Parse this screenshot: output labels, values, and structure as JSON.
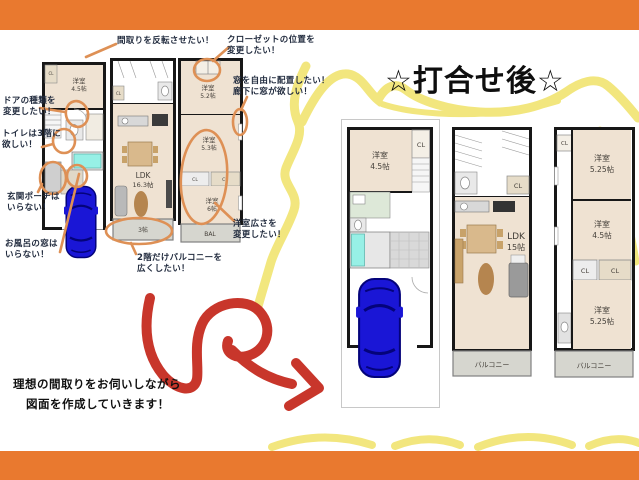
{
  "title": {
    "text": "☆打合せ後☆"
  },
  "message": {
    "line1": "理想の間取りをお伺いしながら",
    "line2": "図面を作成していきます！"
  },
  "annotations": {
    "flip": {
      "line1": "間取りを反転させたい！"
    },
    "closet": {
      "line1": "クローゼットの位置を",
      "line2": "変更したい！"
    },
    "free_window": {
      "line1": "窓を自由に配置したい！",
      "line2": "廊下に窓が欲しい！"
    },
    "door": {
      "line1": "ドアの種類を",
      "line2": "変更したい！"
    },
    "toilet": {
      "line1": "トイレは3階に",
      "line2": "欲しい！"
    },
    "porch": {
      "line1": "玄関ポーチは",
      "line2": "いらない！"
    },
    "bath_window": {
      "line1": "お風呂の窓は",
      "line2": "いらない！"
    },
    "room_size": {
      "line1": "洋室広さを",
      "line2": "変更したい！"
    },
    "balcony": {
      "line1": "2階だけバルコニーを",
      "line2": "広くしたい！"
    }
  },
  "before_plans": {
    "floor1": {
      "room1_name": "洋室",
      "room1_size": "4.5帖",
      "closet": "CL"
    },
    "floor2": {
      "closet": "CL",
      "ldk_name": "LDK",
      "ldk_size": "16.3帖",
      "balcony": "3帖"
    },
    "floor3": {
      "room1_name": "洋室",
      "room1_size": "5.2帖",
      "room2_name": "洋室",
      "room2_size": "5.3帖",
      "closet1": "CL",
      "closet2": "CL",
      "room3_name": "洋室",
      "room3_size": "6帖",
      "balcony": "BAL"
    }
  },
  "after_plans": {
    "floor1": {
      "room1_name": "洋室",
      "room1_size": "4.5帖",
      "closet": "CL"
    },
    "floor2": {
      "closet": "CL",
      "ldk_name": "LDK",
      "ldk_size": "15帖",
      "balcony": "バルコニー"
    },
    "floor3": {
      "closet_top": "CL",
      "room1_name": "洋室",
      "room1_size": "5.25帖",
      "room2_name": "洋室",
      "room2_size": "4.5帖",
      "closet1": "CL",
      "closet2": "CL",
      "room3_name": "洋室",
      "room3_size": "5.25帖",
      "balcony": "バルコニー"
    }
  },
  "colors": {
    "accent_orange": "#E9792F",
    "annotation_marker": "#DE9055",
    "highlight_yellow": "#EFE15E",
    "arrow_red": "#C8362B",
    "car_blue": "#1A16D6",
    "floor_beige": "#EFE2D2",
    "bath_cyan": "#97F0E6"
  }
}
